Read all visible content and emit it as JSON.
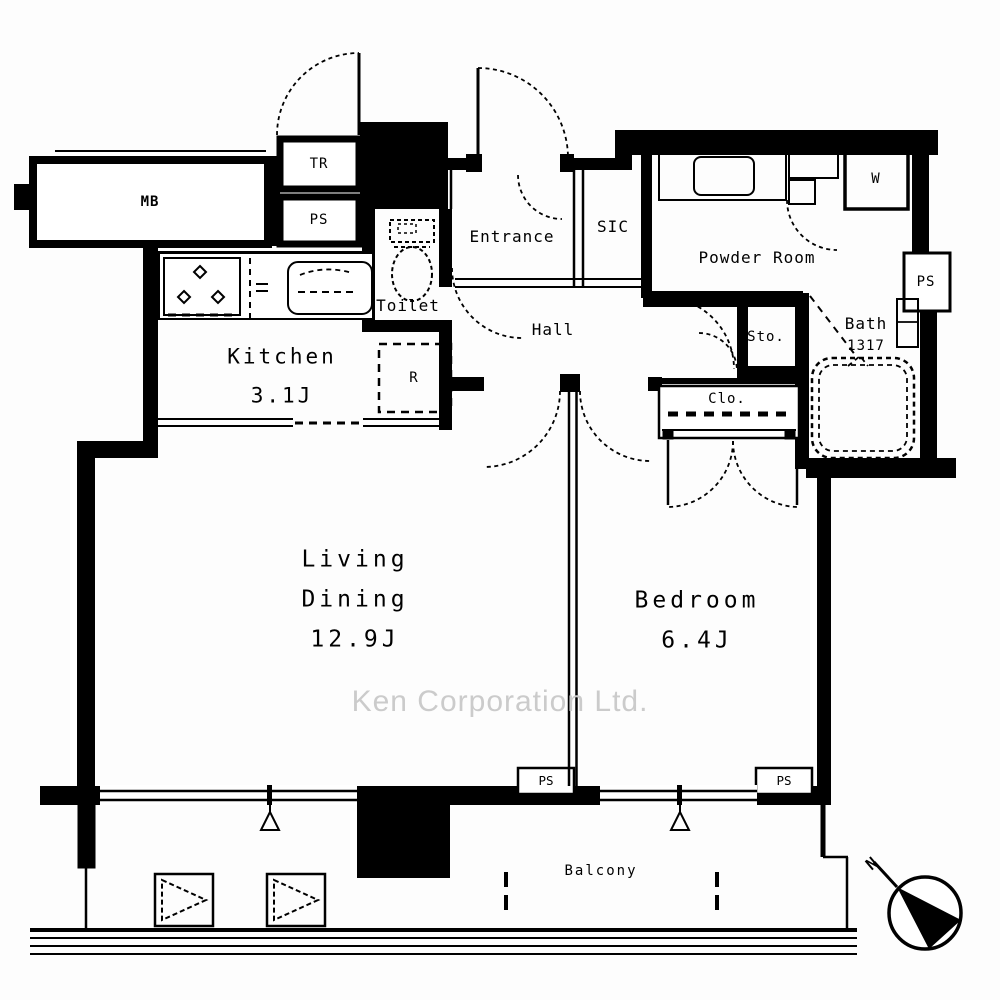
{
  "watermark": "Ken Corporation Ltd.",
  "compass": {
    "north": "N"
  },
  "colors": {
    "line": "#000000",
    "watermark": "#cbcbcb",
    "background": "#fdfdfd"
  },
  "rooms": {
    "mb": {
      "label": "MB"
    },
    "tr": {
      "label": "TR"
    },
    "ps_top": {
      "label": "PS"
    },
    "toilet": {
      "label": "Toilet"
    },
    "entrance": {
      "label": "Entrance"
    },
    "sic": {
      "label": "SIC"
    },
    "powder_room": {
      "label": "Powder Room"
    },
    "washer": {
      "label": "W"
    },
    "ps_right": {
      "label": "PS"
    },
    "hall": {
      "label": "Hall"
    },
    "sto": {
      "label": "Sto."
    },
    "bath": {
      "label": "Bath",
      "size": "1317"
    },
    "clo": {
      "label": "Clo."
    },
    "kitchen": {
      "label": "Kitchen",
      "size": "3.1J"
    },
    "fridge": {
      "label": "R"
    },
    "living_dining": {
      "line1": "Living",
      "line2": "Dining",
      "size": "12.9J"
    },
    "bedroom": {
      "label": "Bedroom",
      "size": "6.4J"
    },
    "ps_bottom_left": {
      "label": "PS"
    },
    "ps_bottom_right": {
      "label": "PS"
    },
    "balcony": {
      "label": "Balcony"
    }
  }
}
